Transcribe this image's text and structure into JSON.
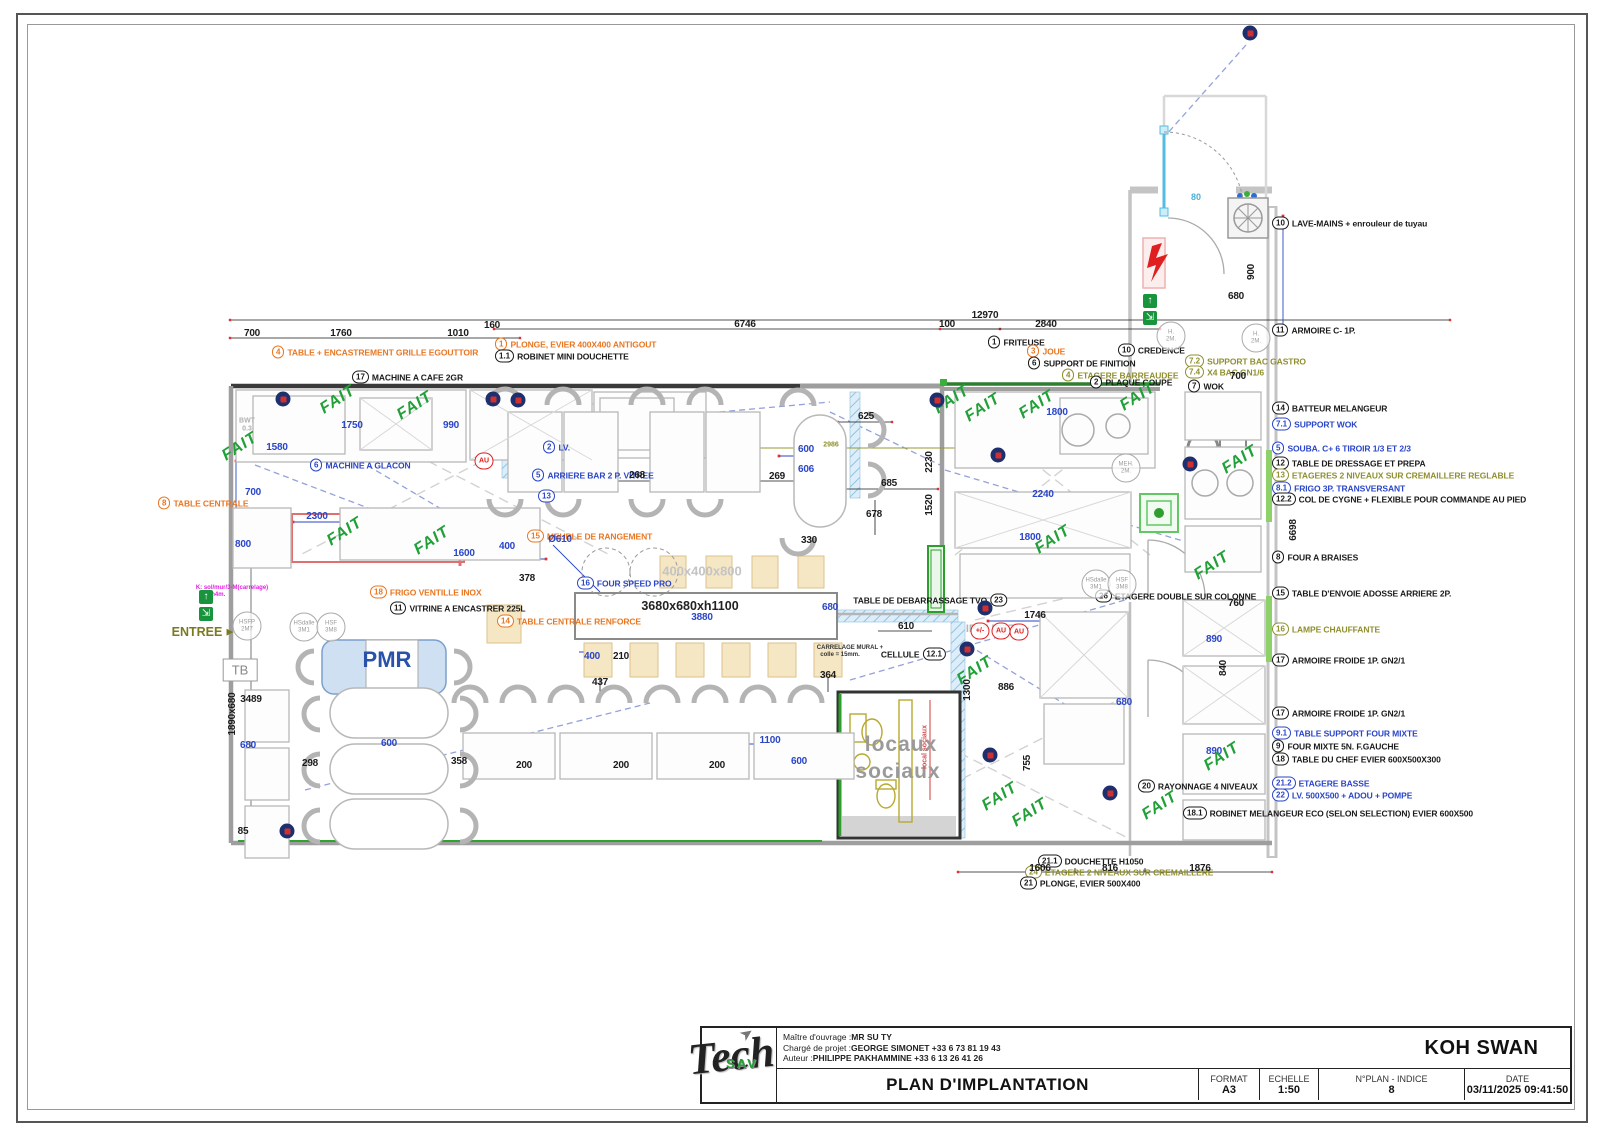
{
  "title_block": {
    "owner_label": "Maître d'ouvrage :",
    "owner": "MR SU TY",
    "pm_label": "Chargé de projet :",
    "pm": "GEORGE SIMONET +33 6 73 81 19 43",
    "author_label": "Auteur :",
    "author": "PHILIPPE PAKHAMMINE +33 6 13 26 41 26",
    "project": "KOH SWAN",
    "title": "PLAN D'IMPLANTATION",
    "format_label": "FORMAT",
    "format": "A3",
    "echelle_label": "ECHELLE",
    "echelle": "1:50",
    "plan_label": "N°PLAN - INDICE",
    "plan_indice": "8",
    "date_label": "DATE",
    "date": "03/11/2025 09:41:50",
    "logo_sav": "SAV",
    "logo_tech": "Tech",
    "logo_arrow": "➤"
  },
  "colors": {
    "accent_orange": "#e87722",
    "accent_blue": "#2a46c8",
    "accent_olive": "#8f8f2f",
    "stamp_green": "#21a038",
    "alert_red": "#e02020",
    "navy": "#1e2f6e"
  },
  "legend": [
    {
      "id": "10",
      "t": "LAVE-MAINS + enrouleur de tuyau",
      "c": "black",
      "y": 223
    },
    {
      "id": "11",
      "t": "ARMOIRE C- 1P.",
      "c": "black",
      "y": 330
    },
    {
      "id": "14",
      "t": "BATTEUR MELANGEUR",
      "c": "black",
      "y": 408
    },
    {
      "id": "7.1",
      "t": "SUPPORT WOK",
      "c": "blue",
      "y": 424
    },
    {
      "id": "5",
      "t": "SOUBA. C+ 6 TIROIR 1/3 ET 2/3",
      "c": "blue",
      "y": 448
    },
    {
      "id": "12",
      "t": "TABLE DE DRESSAGE ET PREPA",
      "c": "black",
      "y": 463
    },
    {
      "id": "13",
      "t": "ETAGERES 2 NIVEAUX SUR CREMAILLERE REGLABLE",
      "c": "olive",
      "y": 475
    },
    {
      "id": "8.1",
      "t": "FRIGO 3P. TRANSVERSANT",
      "c": "blue",
      "y": 488
    },
    {
      "id": "12.2",
      "t": "COL DE CYGNE + FLEXIBLE POUR COMMANDE AU PIED",
      "c": "black",
      "y": 499
    },
    {
      "id": "8",
      "t": "FOUR A BRAISES",
      "c": "black",
      "y": 557
    },
    {
      "id": "15",
      "t": "TABLE D'ENVOIE ADOSSE ARRIERE 2P.",
      "c": "black",
      "y": 593
    },
    {
      "id": "16",
      "t": "LAMPE CHAUFFANTE",
      "c": "olive",
      "y": 629
    },
    {
      "id": "17",
      "t": "ARMOIRE FROIDE 1P. GN2/1",
      "c": "black",
      "y": 660
    },
    {
      "id": "17",
      "t": "ARMOIRE FROIDE 1P. GN2/1",
      "c": "black",
      "y": 713
    },
    {
      "id": "9.1",
      "t": "TABLE SUPPORT FOUR MIXTE",
      "c": "blue",
      "y": 733
    },
    {
      "id": "9",
      "t": "FOUR MIXTE 5N. F.GAUCHE",
      "c": "black",
      "y": 746
    },
    {
      "id": "18",
      "t": "TABLE DU CHEF EVIER 600X500X300",
      "c": "black",
      "y": 759
    },
    {
      "id": "21.2",
      "t": "ETAGERE BASSE",
      "c": "blue",
      "y": 783
    },
    {
      "id": "22",
      "t": "LV. 500X500 + ADOU + POMPE",
      "c": "blue",
      "y": 795
    }
  ],
  "callouts": [
    {
      "id": "4",
      "t": "TABLE + ENCASTREMENT GRILLE EGOUTTOIR",
      "c": "orange",
      "x": 272,
      "y": 352
    },
    {
      "id": "1",
      "t": "PLONGE, EVIER 400X400 ANTIGOUT",
      "c": "orange",
      "x": 495,
      "y": 344
    },
    {
      "id": "1.1",
      "t": "ROBINET MINI DOUCHETTE",
      "c": "black",
      "x": 495,
      "y": 356
    },
    {
      "id": "17",
      "t": "MACHINE A CAFE 2GR",
      "c": "black",
      "x": 352,
      "y": 377
    },
    {
      "id": "6",
      "t": "MACHINE A GLACON",
      "c": "blue",
      "x": 310,
      "y": 465
    },
    {
      "id": "2",
      "t": "LV.",
      "c": "blue",
      "x": 543,
      "y": 447
    },
    {
      "id": "5",
      "t": "ARRIERE BAR 2 P. VITREE",
      "c": "blue",
      "x": 532,
      "y": 475
    },
    {
      "id": "13",
      "t": "",
      "c": "blue",
      "x": 538,
      "y": 496
    },
    {
      "id": "15",
      "t": "MEUBLE DE RANGEMENT",
      "c": "orange",
      "x": 527,
      "y": 536
    },
    {
      "id": "18",
      "t": "FRIGO VENTILLE INOX",
      "c": "orange",
      "x": 370,
      "y": 592
    },
    {
      "id": "11",
      "t": "VITRINE A ENCASTRER 225L",
      "c": "black",
      "x": 390,
      "y": 608
    },
    {
      "id": "14",
      "t": "TABLE CENTRALE RENFORCE",
      "c": "orange",
      "x": 497,
      "y": 621
    },
    {
      "id": "16",
      "t": "FOUR SPEED PRO",
      "c": "blue",
      "x": 577,
      "y": 583
    },
    {
      "id": "8",
      "t": "TABLE CENTRALE",
      "c": "orange",
      "x": 158,
      "y": 503
    },
    {
      "id": "1",
      "t": "FRITEUSE",
      "c": "black",
      "x": 988,
      "y": 342
    },
    {
      "id": "3",
      "t": "JOUE",
      "c": "orange",
      "x": 1027,
      "y": 351
    },
    {
      "id": "6",
      "t": "SUPPORT DE FINITION",
      "c": "black",
      "x": 1028,
      "y": 363
    },
    {
      "id": "10",
      "t": "CREDENCE",
      "c": "black",
      "x": 1118,
      "y": 350
    },
    {
      "id": "4",
      "t": "ETAGERE BARREAUDEE",
      "c": "olive",
      "x": 1062,
      "y": 375
    },
    {
      "id": "2",
      "t": "PLAQUE COUPE",
      "c": "black",
      "x": 1090,
      "y": 382
    },
    {
      "id": "7.2",
      "t": "SUPPORT BAC GASTRO",
      "c": "olive",
      "x": 1185,
      "y": 361
    },
    {
      "id": "7.4",
      "t": "X4 BAC GN1/6",
      "c": "olive",
      "x": 1185,
      "y": 372
    },
    {
      "id": "7",
      "t": "WOK",
      "c": "black",
      "x": 1188,
      "y": 386
    },
    {
      "id": "23",
      "t": "",
      "c": "black",
      "x": 1007,
      "y": 600,
      "pre": "TABLE DE DEBARRASSAGE TVO"
    },
    {
      "id": "12.1",
      "t": "",
      "c": "black",
      "x": 946,
      "y": 654,
      "pre": "CELLULE"
    },
    {
      "id": "26",
      "t": "ETAGERE DOUBLE SUR COLONNE",
      "c": "black",
      "x": 1095,
      "y": 596
    },
    {
      "id": "20",
      "t": "RAYONNAGE 4 NIVEAUX",
      "c": "black",
      "x": 1138,
      "y": 786
    },
    {
      "id": "21.1",
      "t": "DOUCHETTE H1050",
      "c": "black",
      "x": 1038,
      "y": 861
    },
    {
      "id": "24",
      "t": "ETAGERE 2 NIVEAUX SUR CREMAILLERE",
      "c": "olive",
      "x": 1025,
      "y": 872
    },
    {
      "id": "21",
      "t": "PLONGE, EVIER 500X400",
      "c": "black",
      "x": 1020,
      "y": 883
    },
    {
      "id": "18.1",
      "t": "ROBINET MELANGEUR ECO (SELON SELECTION) EVIER 600X500",
      "c": "black",
      "x": 1183,
      "y": 813
    }
  ],
  "dims": [
    {
      "t": "12970",
      "x": 985,
      "y": 316,
      "c": "k"
    },
    {
      "t": "6746",
      "x": 745,
      "y": 325,
      "c": "k"
    },
    {
      "t": "700",
      "x": 252,
      "y": 334,
      "c": "k"
    },
    {
      "t": "1760",
      "x": 341,
      "y": 334,
      "c": "k"
    },
    {
      "t": "1010",
      "x": 458,
      "y": 334,
      "c": "k"
    },
    {
      "t": "160",
      "x": 492,
      "y": 326,
      "c": "k"
    },
    {
      "t": "100",
      "x": 947,
      "y": 325,
      "c": "k"
    },
    {
      "t": "2840",
      "x": 1046,
      "y": 325,
      "c": "k"
    },
    {
      "t": "1580",
      "x": 277,
      "y": 448,
      "c": "b"
    },
    {
      "t": "1750",
      "x": 352,
      "y": 426,
      "c": "b"
    },
    {
      "t": "990",
      "x": 451,
      "y": 426,
      "c": "b"
    },
    {
      "t": "700",
      "x": 253,
      "y": 493,
      "c": "b"
    },
    {
      "t": "800",
      "x": 243,
      "y": 545,
      "c": "b"
    },
    {
      "t": "2300",
      "x": 317,
      "y": 517,
      "c": "b"
    },
    {
      "t": "1600",
      "x": 464,
      "y": 554,
      "c": "b"
    },
    {
      "t": "400",
      "x": 507,
      "y": 547,
      "c": "b"
    },
    {
      "t": "Ø610",
      "x": 560,
      "y": 540,
      "c": "b"
    },
    {
      "t": "268",
      "x": 637,
      "y": 476,
      "c": "k"
    },
    {
      "t": "269",
      "x": 777,
      "y": 477,
      "c": "k"
    },
    {
      "t": "600",
      "x": 806,
      "y": 450,
      "c": "b"
    },
    {
      "t": "606",
      "x": 806,
      "y": 470,
      "c": "b"
    },
    {
      "t": "625",
      "x": 866,
      "y": 417,
      "c": "k"
    },
    {
      "t": "685",
      "x": 889,
      "y": 484,
      "c": "k"
    },
    {
      "t": "678",
      "x": 874,
      "y": 515,
      "c": "k"
    },
    {
      "t": "330",
      "x": 809,
      "y": 541,
      "c": "k"
    },
    {
      "t": "378",
      "x": 527,
      "y": 579,
      "c": "k"
    },
    {
      "t": "3880",
      "x": 702,
      "y": 618,
      "c": "b"
    },
    {
      "t": "680",
      "x": 830,
      "y": 608,
      "c": "b"
    },
    {
      "t": "400",
      "x": 592,
      "y": 657,
      "c": "b"
    },
    {
      "t": "210",
      "x": 621,
      "y": 657,
      "c": "k"
    },
    {
      "t": "437",
      "x": 600,
      "y": 683,
      "c": "k"
    },
    {
      "t": "610",
      "x": 906,
      "y": 627,
      "c": "k"
    },
    {
      "t": "364",
      "x": 828,
      "y": 676,
      "c": "k"
    },
    {
      "t": "3489",
      "x": 251,
      "y": 700,
      "c": "k"
    },
    {
      "t": "680",
      "x": 248,
      "y": 746,
      "c": "b"
    },
    {
      "t": "600",
      "x": 389,
      "y": 744,
      "c": "b"
    },
    {
      "t": "298",
      "x": 310,
      "y": 764,
      "c": "k"
    },
    {
      "t": "358",
      "x": 459,
      "y": 762,
      "c": "k"
    },
    {
      "t": "200",
      "x": 524,
      "y": 766,
      "c": "k"
    },
    {
      "t": "200",
      "x": 621,
      "y": 766,
      "c": "k"
    },
    {
      "t": "200",
      "x": 717,
      "y": 766,
      "c": "k"
    },
    {
      "t": "1100",
      "x": 770,
      "y": 741,
      "c": "b"
    },
    {
      "t": "600",
      "x": 799,
      "y": 762,
      "c": "b"
    },
    {
      "t": "85",
      "x": 243,
      "y": 832,
      "c": "k"
    },
    {
      "t": "1746",
      "x": 1035,
      "y": 616,
      "c": "k"
    },
    {
      "t": "886",
      "x": 1006,
      "y": 688,
      "c": "k"
    },
    {
      "t": "680",
      "x": 1124,
      "y": 703,
      "c": "b"
    },
    {
      "t": "1606",
      "x": 1040,
      "y": 869,
      "c": "k"
    },
    {
      "t": "816",
      "x": 1110,
      "y": 869,
      "c": "k"
    },
    {
      "t": "1876",
      "x": 1200,
      "y": 869,
      "c": "k"
    },
    {
      "t": "700",
      "x": 1238,
      "y": 377,
      "c": "k"
    },
    {
      "t": "760",
      "x": 1236,
      "y": 604,
      "c": "k"
    },
    {
      "t": "1800",
      "x": 1057,
      "y": 413,
      "c": "b"
    },
    {
      "t": "2240",
      "x": 1043,
      "y": 495,
      "c": "b"
    },
    {
      "t": "1800",
      "x": 1030,
      "y": 538,
      "c": "b"
    },
    {
      "t": "890",
      "x": 1214,
      "y": 640,
      "c": "b"
    },
    {
      "t": "890",
      "x": 1214,
      "y": 752,
      "c": "b"
    },
    {
      "t": "680",
      "x": 1236,
      "y": 297,
      "c": "k"
    },
    {
      "t": "900",
      "x": 1252,
      "y": 272,
      "c": "k",
      "rot": -90
    },
    {
      "t": "2230",
      "x": 930,
      "y": 462,
      "c": "k",
      "rot": -90
    },
    {
      "t": "1520",
      "x": 930,
      "y": 505,
      "c": "k",
      "rot": -90
    },
    {
      "t": "1890x680",
      "x": 233,
      "y": 714,
      "c": "k",
      "rot": -90
    },
    {
      "t": "1300",
      "x": 968,
      "y": 690,
      "c": "k",
      "rot": -90
    },
    {
      "t": "755",
      "x": 1028,
      "y": 763,
      "c": "k",
      "rot": -90
    },
    {
      "t": "840",
      "x": 1224,
      "y": 668,
      "c": "k",
      "rot": -90
    },
    {
      "t": "6698",
      "x": 1294,
      "y": 530,
      "c": "k",
      "rot": -90
    }
  ],
  "texts": [
    {
      "t": "PMR",
      "x": 387,
      "y": 660,
      "cls": "pmr"
    },
    {
      "t": "locaux",
      "x": 901,
      "y": 745,
      "cls": "room"
    },
    {
      "t": "sociaux",
      "x": 898,
      "y": 772,
      "cls": "room"
    },
    {
      "t": "3680x680xh1100",
      "x": 690,
      "y": 606,
      "cls": "btable"
    },
    {
      "t": "400x400x800",
      "x": 702,
      "y": 571,
      "cls": "ghostbig"
    },
    {
      "t": "IP65 IP67",
      "x": 990,
      "y": 629,
      "cls": "ghost"
    },
    {
      "t": "ENTREE",
      "x": 197,
      "y": 632,
      "cls": "entree"
    },
    {
      "t": "▶",
      "x": 230,
      "y": 632,
      "cls": "entree-arrow"
    },
    {
      "t": "TB",
      "x": 240,
      "y": 670,
      "cls": "tb"
    },
    {
      "t": "CARRELAGE MURAL +",
      "x": 850,
      "y": 648,
      "cls": "tiny"
    },
    {
      "t": "colle = 15mm.",
      "x": 840,
      "y": 655,
      "cls": "tiny"
    },
    {
      "t": "BWT",
      "x": 247,
      "y": 421,
      "cls": "ghost-c"
    },
    {
      "t": "0.3",
      "x": 247,
      "y": 429,
      "cls": "ghost-c"
    },
    {
      "t": "K: sol/mur/3-M(carrelage)",
      "x": 232,
      "y": 588,
      "cls": "magenta"
    },
    {
      "t": "= 2h4m.",
      "x": 214,
      "y": 595,
      "cls": "magenta"
    },
    {
      "t": "80",
      "x": 1196,
      "y": 197,
      "cls": "cyan"
    },
    {
      "t": "2986",
      "x": 831,
      "y": 445,
      "cls": "olive-dim"
    },
    {
      "t": "local sociaux",
      "x": 925,
      "y": 747,
      "cls": "redv",
      "rot": -90
    }
  ],
  "fait": [
    [
      338,
      400
    ],
    [
      415,
      406
    ],
    [
      240,
      447
    ],
    [
      345,
      532
    ],
    [
      432,
      541
    ],
    [
      952,
      400
    ],
    [
      983,
      408
    ],
    [
      1037,
      405
    ],
    [
      1138,
      397
    ],
    [
      1053,
      540
    ],
    [
      1240,
      460
    ],
    [
      1212,
      566
    ],
    [
      975,
      671
    ],
    [
      1000,
      797
    ],
    [
      1030,
      813
    ],
    [
      1160,
      806
    ],
    [
      1222,
      757
    ]
  ],
  "badges": {
    "navy": [
      [
        283,
        399
      ],
      [
        493,
        399
      ],
      [
        518,
        400
      ],
      [
        937,
        400
      ],
      [
        998,
        455
      ],
      [
        1190,
        464
      ],
      [
        985,
        608
      ],
      [
        967,
        649
      ],
      [
        990,
        755
      ],
      [
        287,
        831
      ],
      [
        1110,
        793
      ],
      [
        1250,
        33
      ]
    ],
    "red": [
      {
        "t": "AU",
        "x": 484,
        "y": 461
      },
      {
        "t": "+/-",
        "x": 980,
        "y": 631
      },
      {
        "t": "AU",
        "x": 1001,
        "y": 631
      },
      {
        "t": "AU",
        "x": 1019,
        "y": 632
      }
    ],
    "exit": [
      {
        "g": "↑",
        "x": 206,
        "y": 597
      },
      {
        "g": "⇲",
        "x": 206,
        "y": 614
      },
      {
        "g": "↑",
        "x": 1150,
        "y": 301
      },
      {
        "g": "⇲",
        "x": 1150,
        "y": 318
      }
    ]
  },
  "circles": [
    {
      "a": "HSFP",
      "b": "2M7",
      "x": 247,
      "y": 626
    },
    {
      "a": "HSdalle",
      "b": "3M1",
      "x": 304,
      "y": 627
    },
    {
      "a": "HSF",
      "b": "3M8",
      "x": 331,
      "y": 627
    },
    {
      "a": "HSdalle",
      "b": "3M1",
      "x": 1096,
      "y": 584
    },
    {
      "a": "HSF",
      "b": "3M8",
      "x": 1122,
      "y": 584
    },
    {
      "a": "H.",
      "b": "2M.",
      "x": 1171,
      "y": 336
    },
    {
      "a": "H.",
      "b": "2M.",
      "x": 1256,
      "y": 338
    },
    {
      "a": "MEH.",
      "b": "2M.",
      "x": 1126,
      "y": 468
    }
  ]
}
